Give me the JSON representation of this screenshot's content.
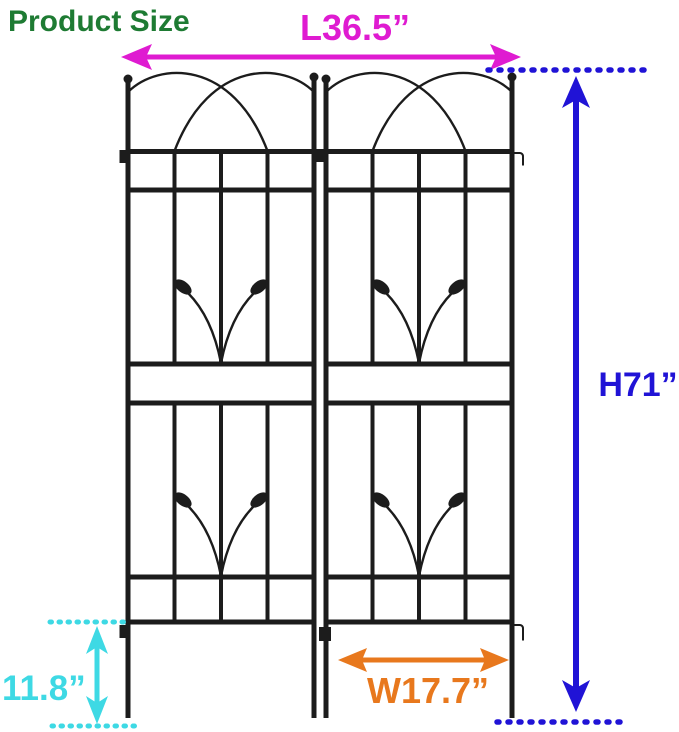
{
  "title": {
    "text": "Product Size",
    "color": "#1e7b33"
  },
  "trellis": {
    "color": "#1c1c1c"
  },
  "dimensions": {
    "length": {
      "label": "L36.5”",
      "color": "#df1bd1"
    },
    "height": {
      "label": "H71”",
      "color": "#2013d6"
    },
    "width": {
      "label": "W17.7”",
      "color": "#e8781d"
    },
    "clearance": {
      "label": "11.8”",
      "color": "#3ed9e4"
    }
  }
}
